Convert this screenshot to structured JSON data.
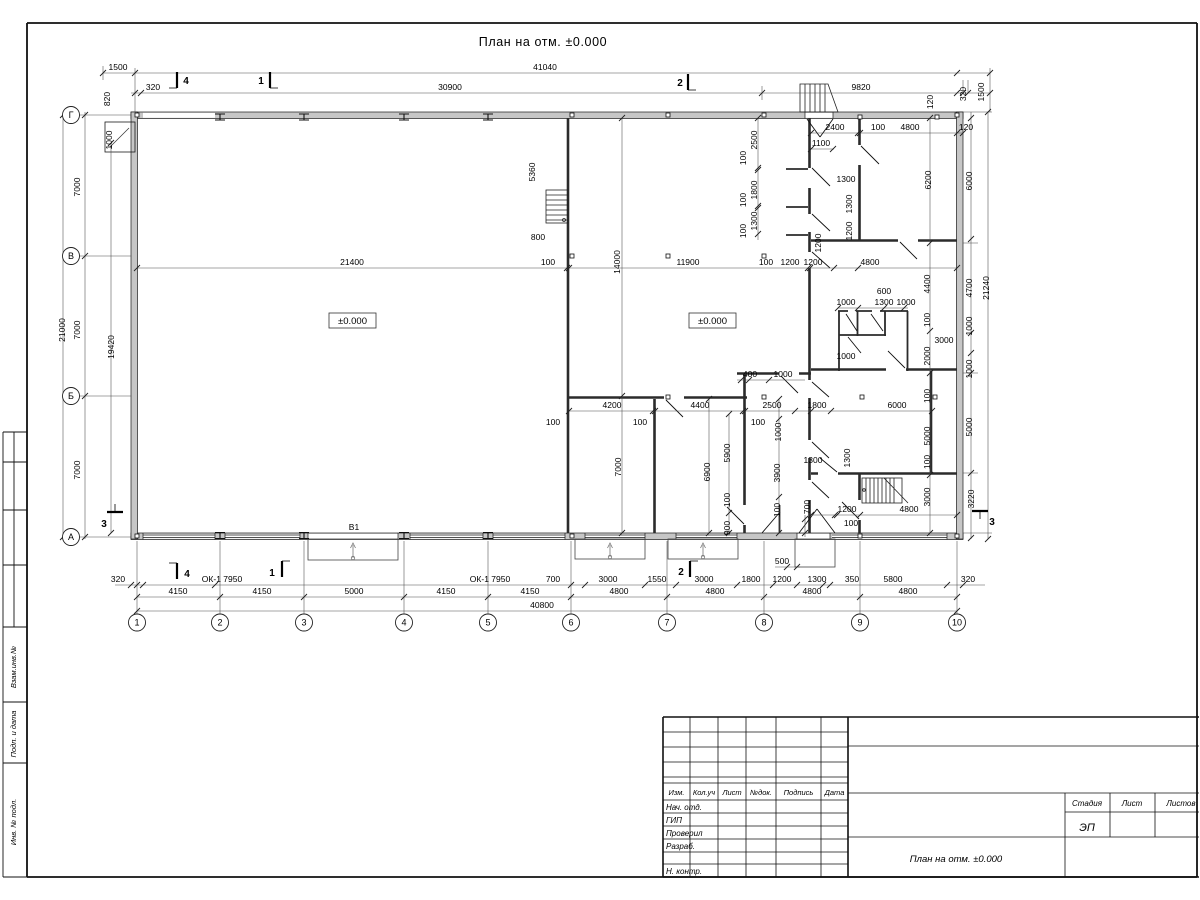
{
  "title": "План на отм. ±0.000",
  "grid": {
    "cols": [
      "1",
      "2",
      "3",
      "4",
      "5",
      "6",
      "7",
      "8",
      "9",
      "10"
    ],
    "rows": [
      "Г",
      "В",
      "Б",
      "А"
    ]
  },
  "sections": {
    "s4": "4",
    "s1": "1",
    "s2": "2",
    "s3": "3"
  },
  "levels": {
    "left": "±0.000",
    "right": "±0.000"
  },
  "windows": {
    "w1": "ОК-1 7950",
    "w2": "ОК-1 7950"
  },
  "gate": "В1",
  "stamp_column": [
    "Взам.инв.№",
    "Подп. и дата",
    "Инв. № подл."
  ],
  "titleblock": {
    "rev_headers": [
      "Изм.",
      "Кол.уч",
      "Лист",
      "№док.",
      "Подпись",
      "Дата"
    ],
    "roles": [
      "Нач. отд.",
      "ГИП",
      "Проверил",
      "Разраб.",
      "Н. контр."
    ],
    "stage_headers": [
      "Стадия",
      "Лист",
      "Листов"
    ],
    "stage": "ЭП",
    "drawing_title": "План на отм. ±0.000"
  },
  "dim_labels": [
    [
      "1500",
      118,
      70,
      0
    ],
    [
      "41040",
      545,
      70,
      0
    ],
    [
      "320",
      153,
      90,
      0
    ],
    [
      "30900",
      450,
      90,
      0
    ],
    [
      "9820",
      861,
      90,
      0
    ],
    [
      "820",
      110,
      99,
      -90
    ],
    [
      "1000",
      112,
      140,
      -90
    ],
    [
      "120",
      933,
      102,
      -90
    ],
    [
      "320",
      966,
      94,
      -90
    ],
    [
      "1500",
      984,
      92,
      -90
    ],
    [
      "2400",
      835,
      130,
      0
    ],
    [
      "100",
      878,
      130,
      0
    ],
    [
      "4800",
      910,
      130,
      0
    ],
    [
      "120",
      966,
      130,
      0
    ],
    [
      "1100",
      821,
      146,
      0
    ],
    [
      "1300",
      846,
      182,
      0
    ],
    [
      "2500",
      757,
      140,
      -90
    ],
    [
      "100",
      746,
      158,
      -90
    ],
    [
      "1800",
      757,
      190,
      -90
    ],
    [
      "100",
      746,
      200,
      -90
    ],
    [
      "1300",
      757,
      221,
      -90
    ],
    [
      "100",
      746,
      231,
      -90
    ],
    [
      "1200",
      821,
      243,
      -90
    ],
    [
      "1300",
      852,
      204,
      -90
    ],
    [
      "1200",
      852,
      231,
      -90
    ],
    [
      "6200",
      931,
      180,
      -90
    ],
    [
      "6000",
      972,
      181,
      -90
    ],
    [
      "5360",
      535,
      172,
      -90
    ],
    [
      "800",
      538,
      240,
      0
    ],
    [
      "7000",
      80,
      187,
      -90
    ],
    [
      "21000",
      65,
      330,
      -90
    ],
    [
      "7000",
      80,
      330,
      -90
    ],
    [
      "19420",
      114,
      347,
      -90
    ],
    [
      "7000",
      80,
      470,
      -90
    ],
    [
      "21400",
      352,
      265,
      0
    ],
    [
      "100",
      548,
      265,
      0
    ],
    [
      "14000",
      620,
      262,
      -90
    ],
    [
      "11900",
      688,
      265,
      0
    ],
    [
      "100",
      766,
      265,
      0
    ],
    [
      "1200",
      790,
      265,
      0
    ],
    [
      "1200",
      813,
      265,
      0
    ],
    [
      "4800",
      870,
      265,
      0
    ],
    [
      "4400",
      930,
      284,
      -90
    ],
    [
      "4700",
      972,
      288,
      -90
    ],
    [
      "21240",
      989,
      288,
      -90
    ],
    [
      "600",
      884,
      294,
      0
    ],
    [
      "1000",
      846,
      305,
      0
    ],
    [
      "1300",
      884,
      305,
      0
    ],
    [
      "1000",
      906,
      305,
      0
    ],
    [
      "100",
      930,
      320,
      -90
    ],
    [
      "3000",
      944,
      343,
      0
    ],
    [
      "2000",
      930,
      356,
      -90
    ],
    [
      "1000",
      846,
      359,
      0
    ],
    [
      "1000",
      972,
      326,
      -90
    ],
    [
      "1000",
      972,
      369,
      -90
    ],
    [
      "100",
      930,
      396,
      -90
    ],
    [
      "1800",
      817,
      408,
      0
    ],
    [
      "6000",
      897,
      408,
      0
    ],
    [
      "2500",
      772,
      408,
      0
    ],
    [
      "4200",
      612,
      408,
      0
    ],
    [
      "4400",
      700,
      408,
      0
    ],
    [
      "100",
      553,
      425,
      0
    ],
    [
      "100",
      640,
      425,
      0
    ],
    [
      "100",
      758,
      425,
      0
    ],
    [
      "400",
      750,
      377,
      0
    ],
    [
      "1000",
      783,
      377,
      0
    ],
    [
      "7000",
      621,
      467,
      -90
    ],
    [
      "6900",
      710,
      472,
      -90
    ],
    [
      "5900",
      730,
      453,
      -90
    ],
    [
      "100",
      730,
      500,
      -90
    ],
    [
      "900",
      730,
      528,
      -90
    ],
    [
      "3900",
      780,
      473,
      -90
    ],
    [
      "100",
      780,
      510,
      -90
    ],
    [
      "1000",
      781,
      432,
      -90
    ],
    [
      "1300",
      813,
      463,
      0
    ],
    [
      "1300",
      850,
      458,
      -90
    ],
    [
      "700",
      810,
      507,
      -90
    ],
    [
      "1200",
      847,
      512,
      0
    ],
    [
      "100",
      851,
      526,
      0
    ],
    [
      "4800",
      909,
      512,
      0
    ],
    [
      "5000",
      930,
      436,
      -90
    ],
    [
      "100",
      930,
      462,
      -90
    ],
    [
      "3000",
      930,
      497,
      -90
    ],
    [
      "5000",
      972,
      427,
      -90
    ],
    [
      "3220",
      974,
      499,
      -90
    ],
    [
      "500",
      782,
      564,
      0
    ],
    [
      "320",
      118,
      582,
      0
    ],
    [
      "700",
      553,
      582,
      0
    ],
    [
      "3000",
      608,
      582,
      0
    ],
    [
      "1550",
      657,
      582,
      0
    ],
    [
      "3000",
      704,
      582,
      0
    ],
    [
      "1800",
      751,
      582,
      0
    ],
    [
      "1200",
      782,
      582,
      0
    ],
    [
      "1300",
      817,
      582,
      0
    ],
    [
      "350",
      852,
      582,
      0
    ],
    [
      "5800",
      893,
      582,
      0
    ],
    [
      "320",
      968,
      582,
      0
    ],
    [
      "4150",
      178,
      594,
      0
    ],
    [
      "4150",
      262,
      594,
      0
    ],
    [
      "5000",
      354,
      594,
      0
    ],
    [
      "4150",
      446,
      594,
      0
    ],
    [
      "4150",
      530,
      594,
      0
    ],
    [
      "4800",
      619,
      594,
      0
    ],
    [
      "4800",
      715,
      594,
      0
    ],
    [
      "4800",
      812,
      594,
      0
    ],
    [
      "4800",
      908,
      594,
      0
    ],
    [
      "40800",
      542,
      608,
      0
    ]
  ]
}
